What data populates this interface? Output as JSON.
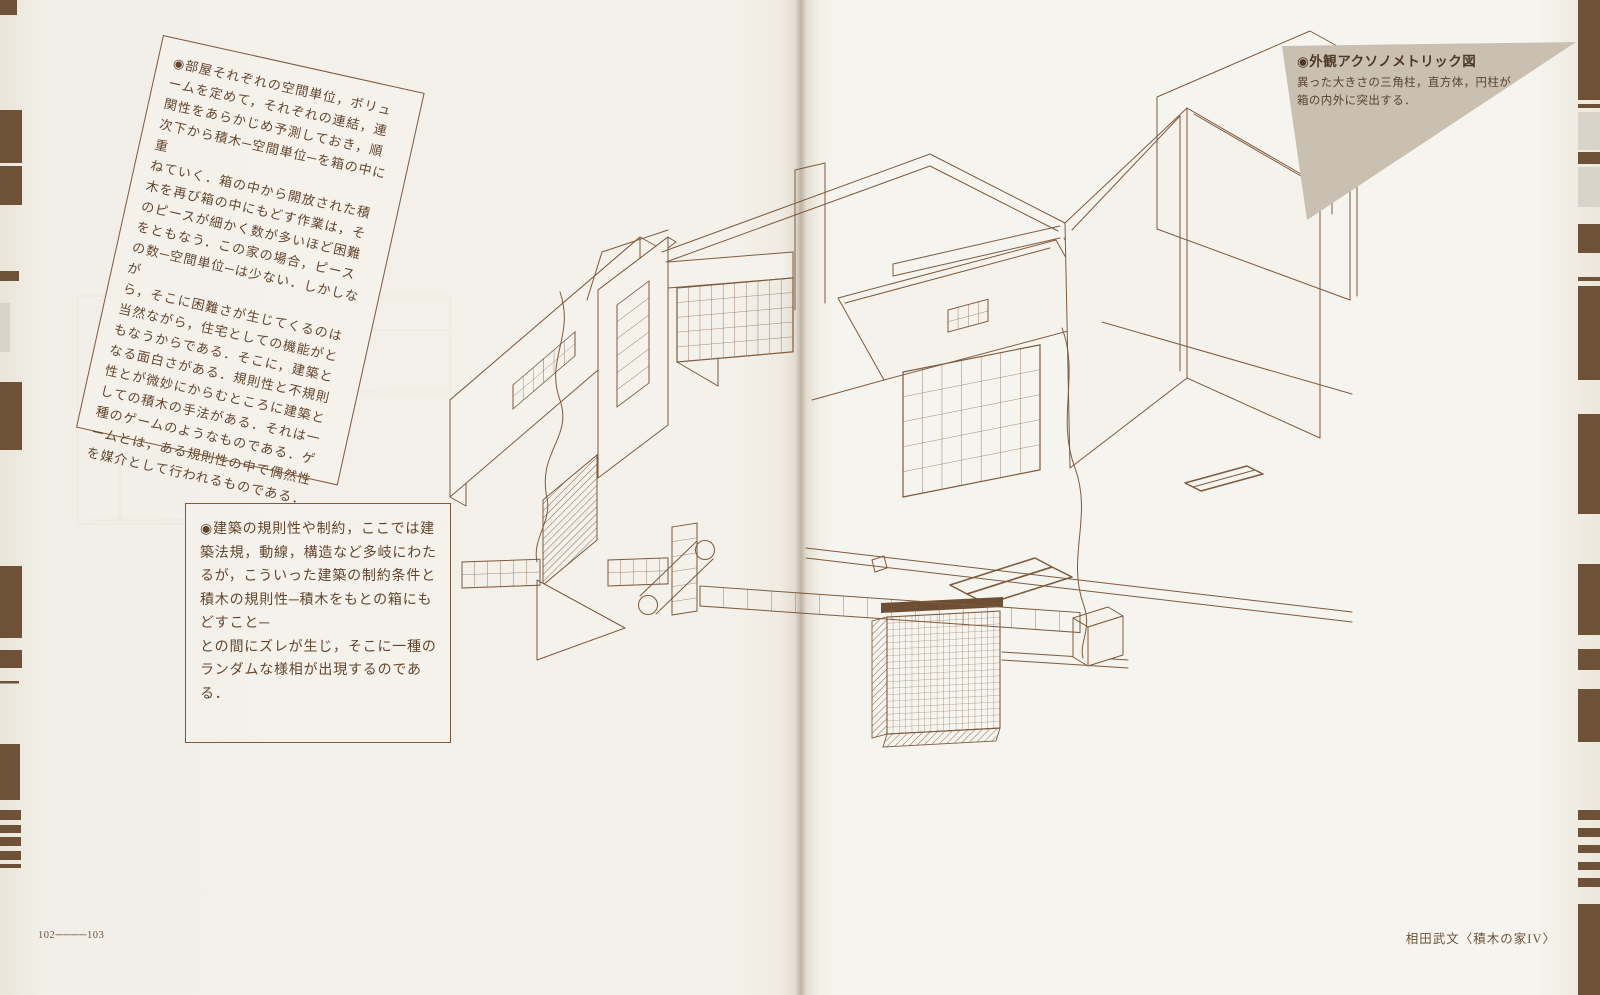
{
  "page": {
    "paper_color": "#f4f1ea",
    "ink_color": "#7d5b3e",
    "edge_mark_color": "#6e5136",
    "caption_bg_color": "#c9c0b1"
  },
  "note_rotated": {
    "text": "◉部屋それぞれの空間単位，ボリュ\nームを定めて，それぞれの連結，連\n関性をあらかじめ予測しておき，順\n次下から積木─空間単位─を箱の中に重\nねていく．箱の中から開放された積\n木を再び箱の中にもどす作業は，そ\nのピースが細かく数が多いほど困難\nをともなう．この家の場合，ピース\nの数─空間単位─は少ない．しかしなが\nら，そこに困難さが生じてくるのは\n当然ながら，住宅としての機能がと\nもなうからである．そこに，建築と\nなる面白さがある．規則性と不規則\n性とが微妙にからむところに建築と\nしての積木の手法がある．それは一\n種のゲームのようなものである．ゲ\nームとは，ある規則性の中で偶然性\nを媒介として行われるものである．"
  },
  "note_boxed": {
    "text": "◉建築の規則性や制約，ここでは建\n築法規，動線，構造など多岐にわた\nるが，こういった建築の制約条件と\n積木の規則性─積木をもとの箱にもどすこと─\nとの間にズレが生じ，そこに一種の\nランダムな様相が出現するのである．"
  },
  "caption": {
    "title": "◉外観アクソノメトリック図",
    "body": "異った大きさの三角柱，直方体，円柱が\n箱の内外に突出する．"
  },
  "footer": {
    "folio": "102────103",
    "credit": "相田武文〈積木の家IV〉"
  },
  "drawing": {
    "label": "外観アクソノメトリック図"
  }
}
